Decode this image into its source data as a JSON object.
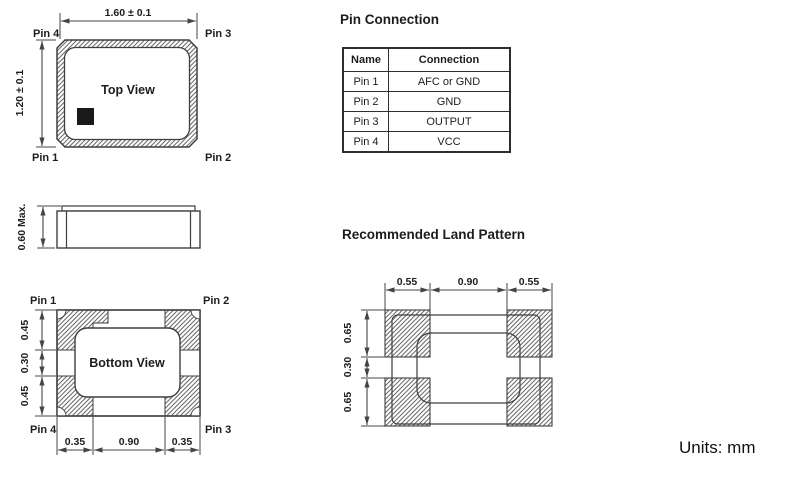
{
  "top_view": {
    "label": "Top View",
    "width_dim": "1.60 ± 0.1",
    "height_dim": "1.20 ± 0.1",
    "pin_top_left": "Pin 4",
    "pin_top_right": "Pin 3",
    "pin_bottom_left": "Pin 1",
    "pin_bottom_right": "Pin 2"
  },
  "side_view": {
    "height_dim": "0.60 Max."
  },
  "bottom_view": {
    "label": "Bottom View",
    "pin_top_left": "Pin 1",
    "pin_top_right": "Pin 2",
    "pin_bottom_left": "Pin 4",
    "pin_bottom_right": "Pin 3",
    "left_dims": {
      "top": "0.45",
      "middle": "0.30",
      "bottom": "0.45"
    },
    "bottom_dims": {
      "left": "0.35",
      "center": "0.90",
      "right": "0.35"
    }
  },
  "pin_connection": {
    "title": "Pin Connection",
    "headers": {
      "name": "Name",
      "connection": "Connection"
    },
    "rows": [
      {
        "name": "Pin 1",
        "connection": "AFC or GND"
      },
      {
        "name": "Pin 2",
        "connection": "GND"
      },
      {
        "name": "Pin 3",
        "connection": "OUTPUT"
      },
      {
        "name": "Pin 4",
        "connection": "VCC"
      }
    ]
  },
  "land_pattern": {
    "title": "Recommended Land Pattern",
    "top_dims": {
      "left": "0.55",
      "center": "0.90",
      "right": "0.55"
    },
    "left_dims": {
      "top": "0.65",
      "middle": "0.30",
      "bottom": "0.65"
    }
  },
  "units_label": "Units: mm",
  "colors": {
    "pin1_marker": "#1a1a1a",
    "line": "#444444",
    "hatch": "#6f6f6f"
  }
}
